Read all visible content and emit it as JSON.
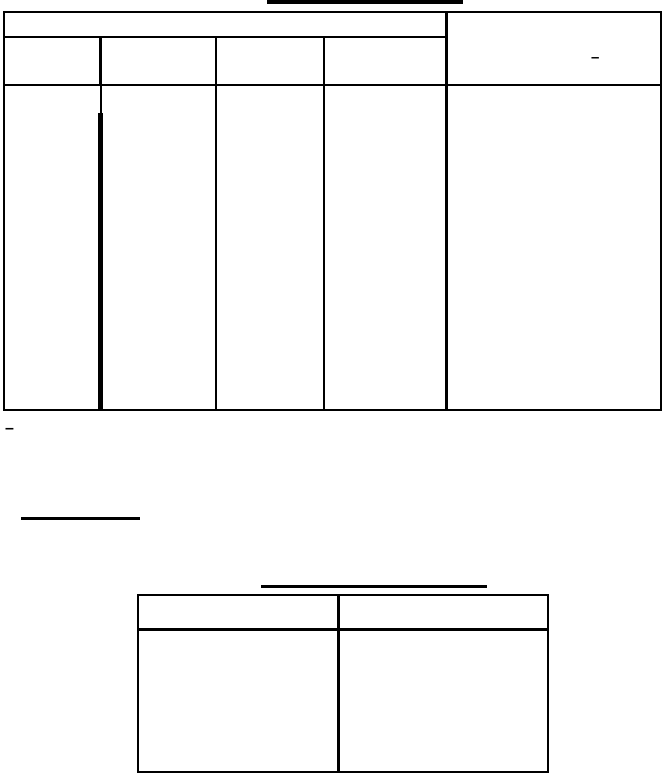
{
  "page": {
    "background_color": "#ffffff",
    "line_color": "#000000"
  },
  "main_table": {
    "span_header_cell": "",
    "header_cells": [
      "",
      "",
      "",
      ""
    ],
    "right_header_cell_dash": "–",
    "body_cells": [
      "",
      "",
      "",
      "",
      ""
    ]
  },
  "after_table_dash": "–",
  "blank_underlined_heading": "",
  "secondary_table": {
    "header_cells": [
      "",
      ""
    ],
    "body_cells": [
      "",
      ""
    ]
  }
}
